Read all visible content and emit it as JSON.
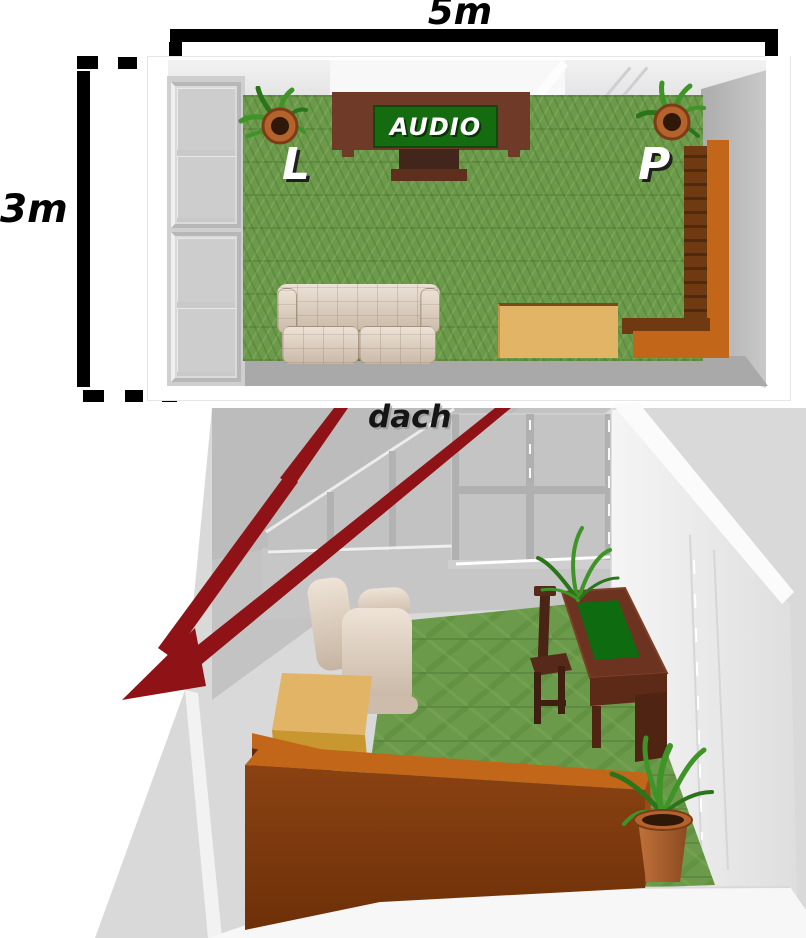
{
  "plan_view": {
    "width_label": "5m",
    "depth_label": "3m",
    "audio_sign": "AUDIO",
    "speaker_left_label": "L",
    "speaker_right_label": "P"
  },
  "perspective_view": {
    "roof_label": "dach"
  },
  "colors": {
    "dimension_black": "#000000",
    "backdrop_gray": "#d9d9d9",
    "wall_gray": "#c6c6c6",
    "wall_dark_gray": "#a9a9a9",
    "ceiling_gray": "#bcbcbc",
    "wall_white": "#f0f0f0",
    "grass_green": "#6b9a4a",
    "grass_dark": "#5d8b3c",
    "grass_light": "#7aa757",
    "arrow_red": "#8e1216",
    "audio_cabinet_brown": "#6f3b28",
    "audio_sign_green": "#156b10",
    "tv_stand_brown": "#43261b",
    "sofa_beige": "#d9cabb",
    "sofa_beige_dark": "#c2b0a0",
    "tan_cabinet": "#e2b466",
    "tan_cabinet_front": "#c9972f",
    "corner_sofa_orange": "#c2661a",
    "corner_sofa_brown": "#6f3a12",
    "corner_sofa_shadow": "#5e2c0e",
    "sofa3d_front_brown": "#7e3a10",
    "desk_brown": "#6b3320",
    "desk_dark_brown": "#4f2413",
    "desk_top_green": "#0e6b10",
    "plant_green": "#3f9427",
    "plant_dark_green": "#2a7519",
    "pot_terracotta": "#b5632c",
    "pot_dark": "#7c3c16"
  }
}
